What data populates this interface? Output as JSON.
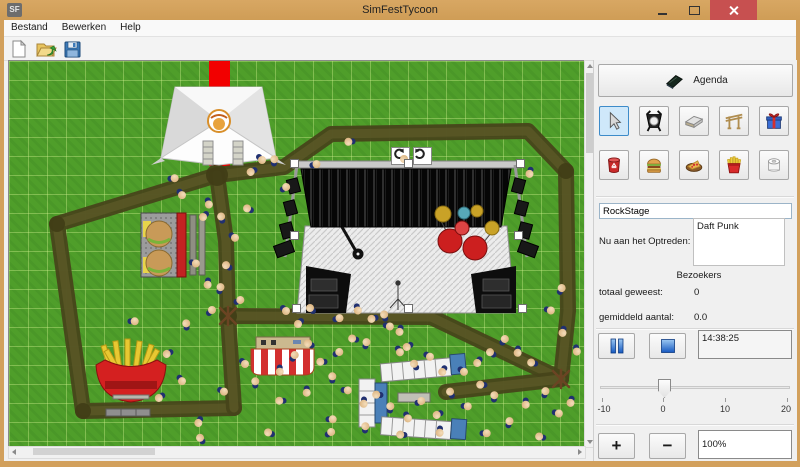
{
  "window": {
    "title": "SimFestTycoon",
    "logo": "SF"
  },
  "menu": {
    "items": [
      "Bestand",
      "Bewerken",
      "Help"
    ]
  },
  "toolbar": {
    "icons": [
      "new-file-icon",
      "open-folder-icon",
      "save-icon"
    ]
  },
  "panel": {
    "agenda_label": "Agenda",
    "tools": [
      "select-cursor",
      "spotlight",
      "stage-ramp",
      "gate-frame",
      "gift",
      "trash-can",
      "burger",
      "pizza",
      "fries",
      "toilet-paper"
    ],
    "selected_tool": "select-cursor",
    "stage_name": "RockStage",
    "now_performing_label": "Nu aan het Optreden:",
    "now_performing": "Daft Punk",
    "visitors_header": "Bezoekers",
    "total_label": "totaal geweest:",
    "total_value": "0",
    "average_label": "gemiddeld aantal:",
    "average_value": "0.0",
    "time_value": "14:38:25",
    "plus_label": "+",
    "minus_label": "−",
    "zoom_value": "100%",
    "slider": {
      "min": -10,
      "max": 20,
      "value": 0,
      "ticks": [
        "-10",
        "0",
        "10",
        "20"
      ]
    }
  },
  "map": {
    "selected_object": "RockStage",
    "colors": {
      "grass": "#4f9e2a",
      "path": "#514e20",
      "carpet": "#f20000",
      "accent_blue": "#cfe8fa"
    },
    "paths": [
      [
        [
          208,
          114
        ],
        [
          275,
          106
        ],
        [
          322,
          73
        ],
        [
          519,
          70
        ],
        [
          557,
          110
        ],
        [
          559,
          250
        ],
        [
          552,
          318
        ]
      ],
      [
        [
          208,
          114
        ],
        [
          48,
          163
        ],
        [
          74,
          350
        ],
        [
          225,
          347
        ]
      ],
      [
        [
          208,
          114
        ],
        [
          217,
          180
        ],
        [
          219,
          255
        ],
        [
          225,
          347
        ]
      ],
      [
        [
          219,
          255
        ],
        [
          422,
          256
        ],
        [
          552,
          318
        ]
      ],
      [
        [
          552,
          318
        ],
        [
          437,
          331
        ]
      ]
    ],
    "junctions": [
      [
        208,
        114,
        11
      ],
      [
        219,
        255,
        9
      ],
      [
        48,
        163,
        8
      ],
      [
        74,
        350,
        8
      ],
      [
        557,
        110,
        8
      ]
    ],
    "dead_trees": [
      [
        552,
        318
      ],
      [
        219,
        255
      ]
    ],
    "selection_handles": [
      [
        285,
        102
      ],
      [
        399,
        102
      ],
      [
        511,
        102
      ],
      [
        285,
        174
      ],
      [
        509,
        174
      ],
      [
        287,
        247
      ],
      [
        399,
        247
      ],
      [
        513,
        247
      ]
    ],
    "rotate_buttons": [
      [
        382,
        86
      ],
      [
        404,
        86
      ]
    ],
    "people": [
      [
        165,
        118,
        40
      ],
      [
        242,
        110,
        200
      ],
      [
        252,
        99,
        90
      ],
      [
        266,
        99,
        320
      ],
      [
        277,
        127,
        10
      ],
      [
        239,
        147,
        250
      ],
      [
        199,
        143,
        120
      ],
      [
        213,
        156,
        300
      ],
      [
        225,
        177,
        80
      ],
      [
        194,
        155,
        180
      ],
      [
        307,
        104,
        30
      ],
      [
        340,
        80,
        220
      ],
      [
        520,
        112,
        150
      ],
      [
        396,
        98,
        270
      ],
      [
        186,
        203,
        60
      ],
      [
        198,
        223,
        140
      ],
      [
        212,
        227,
        330
      ],
      [
        231,
        240,
        20
      ],
      [
        172,
        134,
        100
      ],
      [
        218,
        204,
        260
      ],
      [
        178,
        263,
        310
      ],
      [
        125,
        261,
        45
      ],
      [
        158,
        292,
        200
      ],
      [
        203,
        250,
        0
      ],
      [
        276,
        250,
        90
      ],
      [
        289,
        262,
        180
      ],
      [
        302,
        247,
        270
      ],
      [
        330,
        258,
        30
      ],
      [
        348,
        249,
        120
      ],
      [
        363,
        257,
        210
      ],
      [
        376,
        254,
        300
      ],
      [
        380,
        266,
        60
      ],
      [
        390,
        270,
        150
      ],
      [
        344,
        277,
        240
      ],
      [
        358,
        282,
        330
      ],
      [
        330,
        292,
        15
      ],
      [
        390,
        291,
        105
      ],
      [
        398,
        285,
        195
      ],
      [
        406,
        303,
        285
      ],
      [
        420,
        296,
        75
      ],
      [
        433,
        310,
        165
      ],
      [
        300,
        282,
        255
      ],
      [
        286,
        295,
        345
      ],
      [
        270,
        310,
        135
      ],
      [
        312,
        300,
        225
      ],
      [
        324,
        316,
        315
      ],
      [
        338,
        330,
        50
      ],
      [
        354,
        342,
        140
      ],
      [
        368,
        333,
        230
      ],
      [
        382,
        346,
        320
      ],
      [
        398,
        357,
        110
      ],
      [
        412,
        341,
        20
      ],
      [
        428,
        353,
        200
      ],
      [
        442,
        331,
        290
      ],
      [
        454,
        311,
        80
      ],
      [
        468,
        301,
        170
      ],
      [
        482,
        291,
        260
      ],
      [
        496,
        279,
        350
      ],
      [
        508,
        291,
        140
      ],
      [
        472,
        323,
        230
      ],
      [
        486,
        335,
        320
      ],
      [
        458,
        346,
        50
      ],
      [
        430,
        371,
        140
      ],
      [
        392,
        373,
        230
      ],
      [
        357,
        366,
        320
      ],
      [
        323,
        359,
        45
      ],
      [
        297,
        331,
        135
      ],
      [
        271,
        339,
        225
      ],
      [
        247,
        321,
        315
      ],
      [
        235,
        303,
        90
      ],
      [
        541,
        250,
        60
      ],
      [
        553,
        271,
        150
      ],
      [
        523,
        301,
        240
      ],
      [
        537,
        331,
        330
      ],
      [
        549,
        353,
        60
      ],
      [
        561,
        341,
        150
      ],
      [
        531,
        375,
        240
      ],
      [
        501,
        361,
        330
      ],
      [
        477,
        373,
        45
      ],
      [
        516,
        343,
        135
      ],
      [
        553,
        228,
        340
      ],
      [
        567,
        290,
        125
      ],
      [
        172,
        320,
        100
      ],
      [
        150,
        336,
        190
      ],
      [
        192,
        377,
        280
      ],
      [
        322,
        372,
        10
      ],
      [
        214,
        331,
        70
      ],
      [
        189,
        361,
        160
      ],
      [
        260,
        371,
        250
      ]
    ]
  }
}
